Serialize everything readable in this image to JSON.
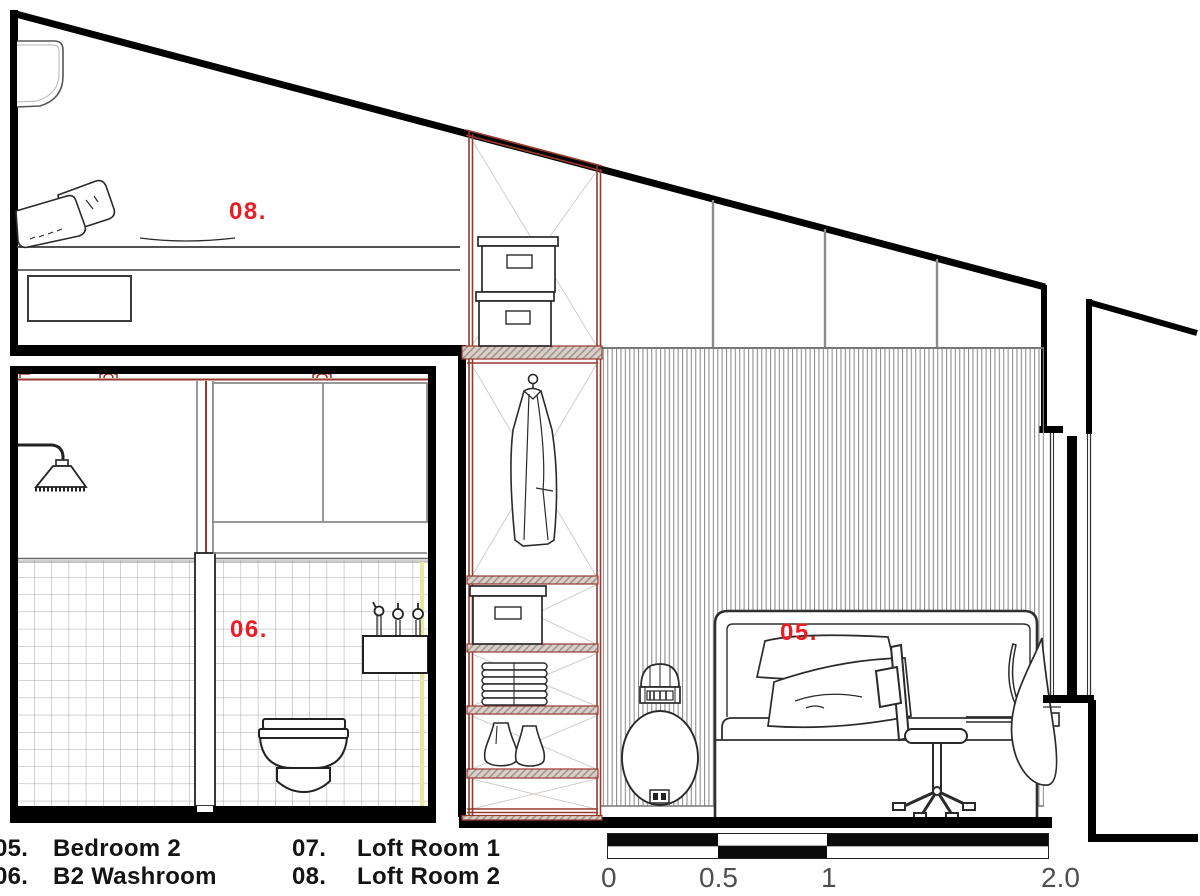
{
  "drawing": {
    "rooms": {
      "bedroom2": {
        "label": "05."
      },
      "washroom": {
        "label": "06."
      },
      "loftroom2": {
        "label": "08."
      }
    },
    "legend": {
      "items": [
        {
          "number": "05.",
          "name": "Bedroom 2"
        },
        {
          "number": "06.",
          "name": "B2 Washroom"
        },
        {
          "number": "07.",
          "name": "Loft Room 1"
        },
        {
          "number": "08.",
          "name": "Loft Room 2"
        }
      ]
    },
    "scale_bar": {
      "ticks": [
        "0",
        "0.5",
        "1",
        "2.0"
      ]
    },
    "colors": {
      "label_red": "#ed1c24",
      "cabinet_red": "#963a2e",
      "ink": "#000000",
      "hatch_gray": "#8f8f8f",
      "tick_gray": "#4f4f4f",
      "waterproof_yellow": "#e9e5a5"
    }
  }
}
